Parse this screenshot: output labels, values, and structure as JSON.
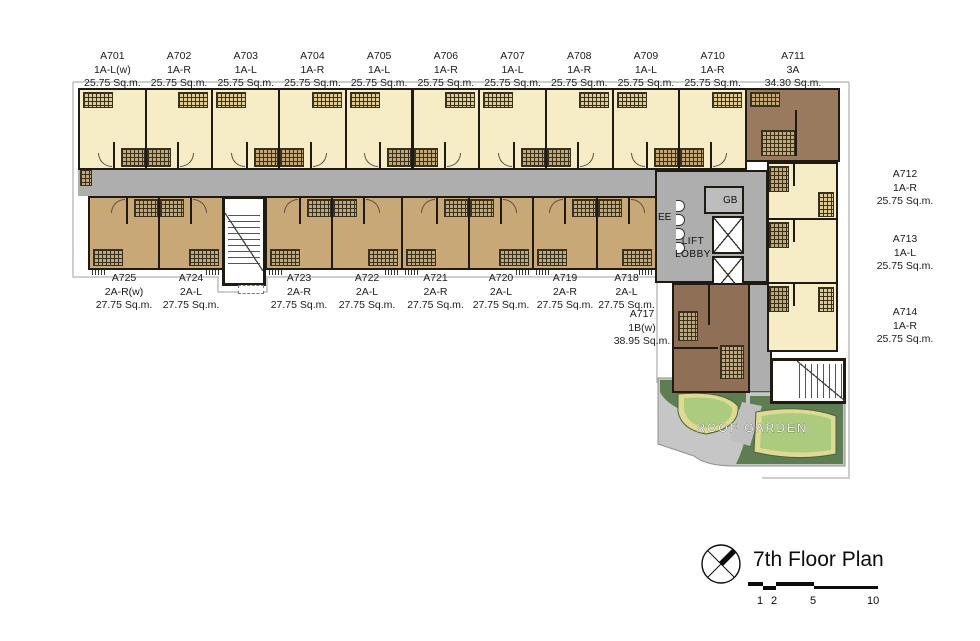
{
  "title": "7th Floor Plan",
  "labels": {
    "ee": "EE",
    "gb": "GB",
    "lift_lobby": "LIFT LOBBY",
    "roof_garden": "ROOF GARDEN"
  },
  "scale_bar": {
    "ticks": [
      "1",
      "2",
      "5",
      "10"
    ]
  },
  "colors": {
    "top_unit": "#F6ECC5",
    "bottom_unit": "#C9A877",
    "dark_unit": "#9A7A5E",
    "corridor": "#AEAEAE",
    "garden_dark_green": "#5F7D53",
    "garden_lawn": "#ACCB7E",
    "garden_path_yellow": "#DEDA92",
    "wall": "#201B12"
  },
  "units": {
    "top_row": [
      {
        "id": "A701",
        "type": "1A-L(w)",
        "area": "25.75 Sq.m."
      },
      {
        "id": "A702",
        "type": "1A-R",
        "area": "25.75 Sq.m."
      },
      {
        "id": "A703",
        "type": "1A-L",
        "area": "25.75 Sq.m."
      },
      {
        "id": "A704",
        "type": "1A-R",
        "area": "25.75 Sq.m."
      },
      {
        "id": "A705",
        "type": "1A-L",
        "area": "25.75 Sq.m."
      },
      {
        "id": "A706",
        "type": "1A-R",
        "area": "25.75 Sq.m."
      },
      {
        "id": "A707",
        "type": "1A-L",
        "area": "25.75 Sq.m."
      },
      {
        "id": "A708",
        "type": "1A-R",
        "area": "25.75 Sq.m."
      },
      {
        "id": "A709",
        "type": "1A-L",
        "area": "25.75 Sq.m."
      },
      {
        "id": "A710",
        "type": "1A-R",
        "area": "25.75 Sq.m."
      }
    ],
    "corner": {
      "id": "A711",
      "type": "3A",
      "area": "34.30 Sq.m."
    },
    "right_column": [
      {
        "id": "A712",
        "type": "1A-R",
        "area": "25.75 Sq.m."
      },
      {
        "id": "A713",
        "type": "1A-L",
        "area": "25.75 Sq.m."
      },
      {
        "id": "A714",
        "type": "1A-R",
        "area": "25.75 Sq.m."
      }
    ],
    "bottom_row": [
      {
        "id": "A725",
        "type": "2A-R(w)",
        "area": "27.75 Sq.m."
      },
      {
        "id": "A724",
        "type": "2A-L",
        "area": "27.75 Sq.m."
      },
      {
        "id": "A723",
        "type": "2A-R",
        "area": "27.75 Sq.m."
      },
      {
        "id": "A722",
        "type": "2A-L",
        "area": "27.75 Sq.m."
      },
      {
        "id": "A721",
        "type": "2A-R",
        "area": "27.75 Sq.m."
      },
      {
        "id": "A720",
        "type": "2A-L",
        "area": "27.75 Sq.m."
      },
      {
        "id": "A719",
        "type": "2A-R",
        "area": "27.75 Sq.m."
      },
      {
        "id": "A718",
        "type": "2A-L",
        "area": "27.75 Sq.m."
      }
    ],
    "lower_unit": {
      "id": "A717",
      "type": "1B(w)",
      "area": "38.95 Sq.m."
    }
  }
}
